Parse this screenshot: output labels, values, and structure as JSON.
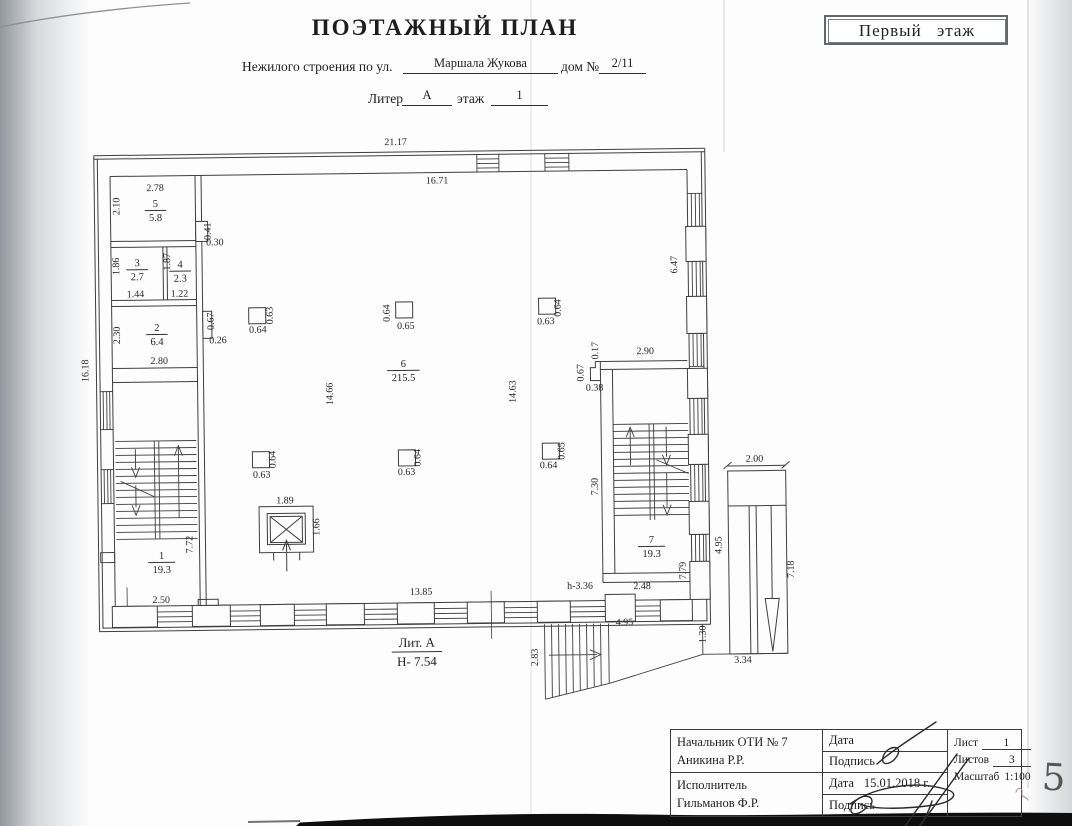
{
  "colors": {
    "paper": "#fdfdfd",
    "ink": "#2e2e2e",
    "wall-line": "#3e3e3e",
    "scan-band": "#0e0e0e",
    "scan-edge": "#9aa0a7"
  },
  "header": {
    "title": "ПОЭТАЖНЫЙ ПЛАН",
    "floor_badge": "Первый этаж",
    "address_label": "Нежилого строения по ул.",
    "address_value": "Маршала Жукова",
    "house_label": "дом №",
    "house_value": "2/11",
    "liter_label": "Литер",
    "liter_value": "А",
    "floor_label": "этаж",
    "floor_value": "1"
  },
  "plan": {
    "liter_annotation": {
      "top": "Лит. А",
      "bottom": "Н- 7.54",
      "x": 414,
      "y": 647
    },
    "rooms": [
      {
        "number": "1",
        "area": "19.3",
        "x": 160,
        "y": 556
      },
      {
        "number": "2",
        "area": "6.4",
        "x": 158,
        "y": 328
      },
      {
        "number": "3",
        "area": "2.7",
        "x": 139,
        "y": 263
      },
      {
        "number": "4",
        "area": "2.3",
        "x": 182,
        "y": 265
      },
      {
        "number": "5",
        "area": "5.8",
        "x": 158,
        "y": 204
      },
      {
        "number": "6",
        "area": "215.5",
        "x": 404,
        "y": 367
      },
      {
        "number": "7",
        "area": "19.3",
        "x": 650,
        "y": 546
      }
    ],
    "dimension_labels": [
      {
        "t": "21.17",
        "x": 399,
        "y": 145,
        "r": 0
      },
      {
        "t": "16.71",
        "x": 440,
        "y": 184,
        "r": 0
      },
      {
        "t": "16.18",
        "x": 89,
        "y": 367,
        "r": -90
      },
      {
        "t": "2.78",
        "x": 158,
        "y": 188,
        "r": 0
      },
      {
        "t": "2.10",
        "x": 122,
        "y": 203,
        "r": -90
      },
      {
        "t": "0.41",
        "x": 213,
        "y": 229,
        "r": -90
      },
      {
        "t": "0.30",
        "x": 217,
        "y": 243,
        "r": 0
      },
      {
        "t": "1.86",
        "x": 121,
        "y": 263,
        "r": -90
      },
      {
        "t": "1.87",
        "x": 172,
        "y": 259,
        "r": -90
      },
      {
        "t": "1.44",
        "x": 137,
        "y": 294,
        "r": 0
      },
      {
        "t": "1.22",
        "x": 181,
        "y": 294,
        "r": 0
      },
      {
        "t": "2.30",
        "x": 121,
        "y": 332,
        "r": -90
      },
      {
        "t": "0.67",
        "x": 215,
        "y": 319,
        "r": -90
      },
      {
        "t": "0.26",
        "x": 219,
        "y": 341,
        "r": 0
      },
      {
        "t": "2.80",
        "x": 160,
        "y": 361,
        "r": 0
      },
      {
        "t": "7.72",
        "x": 191,
        "y": 542,
        "r": -90
      },
      {
        "t": "2.50",
        "x": 159,
        "y": 600,
        "r": 0
      },
      {
        "t": "14.66",
        "x": 333,
        "y": 393,
        "r": -90
      },
      {
        "t": "14.63",
        "x": 516,
        "y": 393,
        "r": -90
      },
      {
        "t": "6.47",
        "x": 679,
        "y": 268,
        "r": -90
      },
      {
        "t": "2.90",
        "x": 646,
        "y": 357,
        "r": 0
      },
      {
        "t": "0.17",
        "x": 599,
        "y": 353,
        "r": -90
      },
      {
        "t": "0.67",
        "x": 584,
        "y": 375,
        "r": -90
      },
      {
        "t": "0.38",
        "x": 595,
        "y": 393,
        "r": 0
      },
      {
        "t": "7.30",
        "x": 597,
        "y": 489,
        "r": -90
      },
      {
        "t": "7.79",
        "x": 684,
        "y": 574,
        "r": -90
      },
      {
        "t": "2.48",
        "x": 640,
        "y": 592,
        "r": 0
      },
      {
        "t": "13.85",
        "x": 419,
        "y": 595,
        "r": 0
      },
      {
        "t": "h-3.36",
        "x": 578,
        "y": 591,
        "r": 0
      },
      {
        "t": "4.95",
        "x": 622,
        "y": 628,
        "r": 0
      },
      {
        "t": "2.83",
        "x": 535,
        "y": 659,
        "r": -90
      },
      {
        "t": "2.00",
        "x": 754,
        "y": 466,
        "r": 0
      },
      {
        "t": "4.95",
        "x": 720,
        "y": 549,
        "r": -90
      },
      {
        "t": "7.18",
        "x": 792,
        "y": 574,
        "r": -90
      },
      {
        "t": "1.30",
        "x": 703,
        "y": 638,
        "r": -90
      },
      {
        "t": "3.34",
        "x": 740,
        "y": 667,
        "r": 0
      },
      {
        "t": "1.89",
        "x": 284,
        "y": 502,
        "r": 0
      },
      {
        "t": "1.66",
        "x": 318,
        "y": 526,
        "r": -90
      },
      {
        "t": "0.63",
        "x": 274,
        "y": 314,
        "r": -90
      },
      {
        "t": "0.64",
        "x": 259,
        "y": 331,
        "r": 0
      },
      {
        "t": "0.64",
        "x": 391,
        "y": 313,
        "r": -90
      },
      {
        "t": "0.65",
        "x": 407,
        "y": 329,
        "r": 0
      },
      {
        "t": "0.64",
        "x": 562,
        "y": 310,
        "r": -90
      },
      {
        "t": "0.63",
        "x": 547,
        "y": 326,
        "r": 0
      },
      {
        "t": "0.64",
        "x": 275,
        "y": 458,
        "r": -90
      },
      {
        "t": "0.63",
        "x": 261,
        "y": 476,
        "r": 0
      },
      {
        "t": "0.64",
        "x": 420,
        "y": 458,
        "r": -90
      },
      {
        "t": "0.63",
        "x": 406,
        "y": 475,
        "r": 0
      },
      {
        "t": "0.65",
        "x": 564,
        "y": 453,
        "r": -90
      },
      {
        "t": "0.64",
        "x": 548,
        "y": 470,
        "r": 0
      }
    ]
  },
  "title_block": {
    "approver_role": "Начальник ОТИ № 7",
    "approver_name": "Аникина Р.Р.",
    "executor_role": "Исполнитель",
    "executor_name": "Гильманов Ф.Р.",
    "date_label": "Дата",
    "signature_label": "Подпись",
    "date_value": "15.01.2018 г.",
    "sheet_label": "Лист",
    "sheet_value": "1",
    "sheets_label": "Листов",
    "sheets_value": "3",
    "scale_label": "Масштаб",
    "scale_value": "1:100"
  },
  "page_marks": {
    "handwritten_number": "5"
  }
}
